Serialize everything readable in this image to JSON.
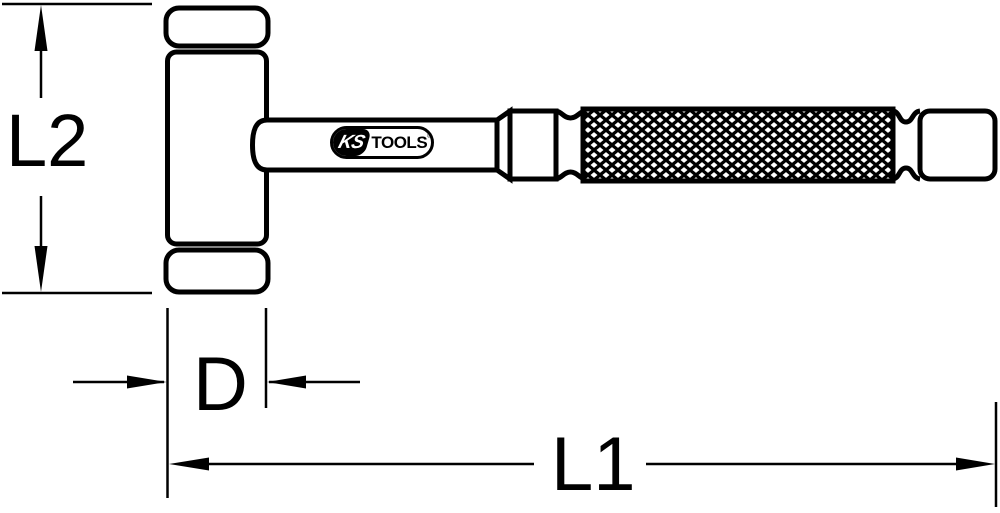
{
  "page": {
    "background": "#ffffff"
  },
  "drawing": {
    "line_color": "#000000",
    "labels": {
      "head_length": "L2",
      "head_diameter": "D",
      "overall_length": "L1"
    },
    "logo": {
      "brand_left": "KS",
      "brand_right": "TOOLS",
      "registered_mark": "®"
    }
  }
}
